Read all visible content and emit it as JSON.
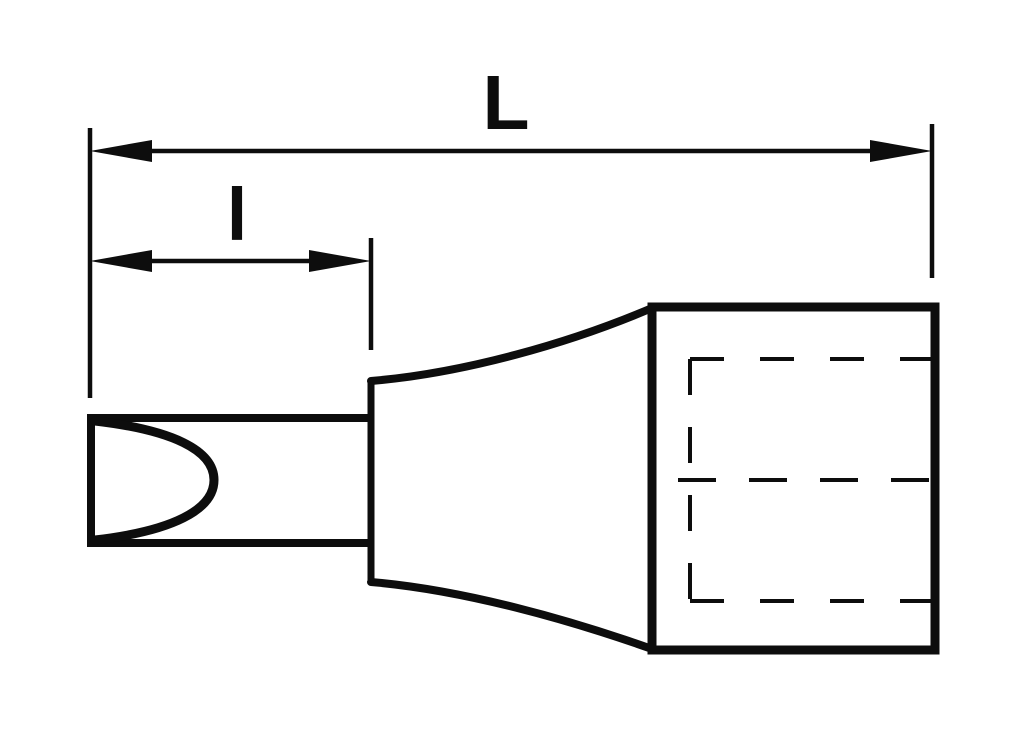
{
  "colors": {
    "ink": "#0d0d0d",
    "paper": "#ffffff"
  },
  "dimensions": {
    "overall_length": {
      "label": "L"
    },
    "bit_length": {
      "label": "l"
    }
  }
}
